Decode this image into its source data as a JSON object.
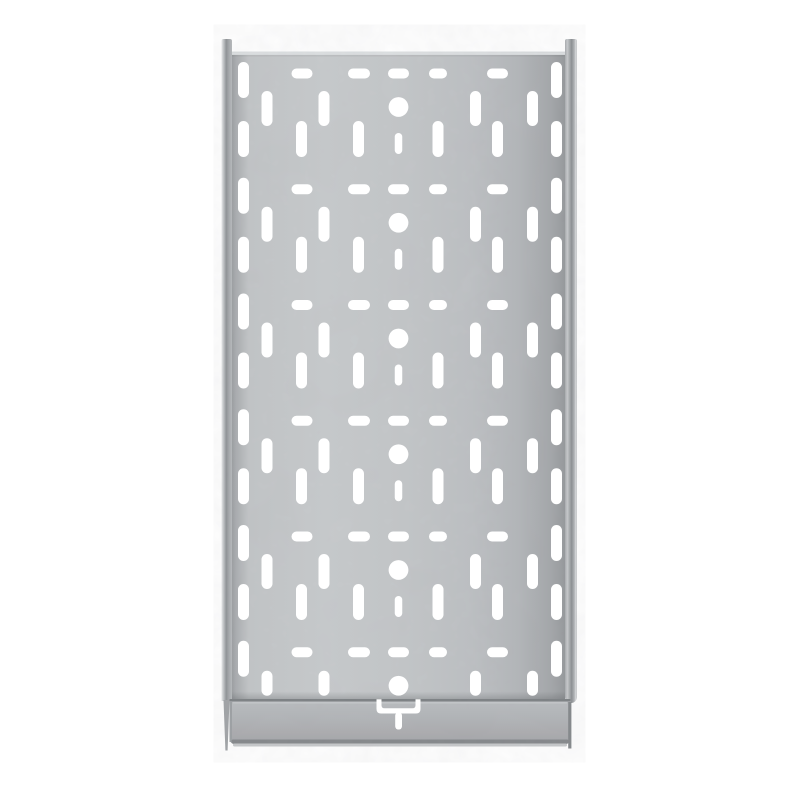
{
  "object": {
    "type": "galvanized-perforated-cable-tray",
    "view": "top-down product photo on white background"
  },
  "canvas": {
    "w": 800,
    "h": 800,
    "bg": "#ffffff"
  },
  "colors": {
    "hole": "#ffffff",
    "seam_dark": "#7c8083",
    "seam_light": "#c3c6c9",
    "bevel_highlight": "#edeff0",
    "bevel_face": "#dde0e2",
    "bevel_shadow": "rgba(0,0,0,0.05)",
    "plate_bottom_edge": "#84878a",
    "plate_bottom_light": "#c6c8ca",
    "plate_left_edge": "#9ca0a3",
    "plate_right_edge": "#83878a",
    "rail_tip": "#a0a3a6"
  },
  "gradients": {
    "railLeft": {
      "dir": "h",
      "stops": [
        [
          0,
          "#eaebec"
        ],
        [
          0.15,
          "#cbced0"
        ],
        [
          0.45,
          "#8f9396"
        ],
        [
          0.75,
          "#a8abae"
        ],
        [
          1,
          "#b6b9bc"
        ]
      ]
    },
    "railRight": {
      "dir": "h",
      "stops": [
        [
          0,
          "#a7aaad"
        ],
        [
          0.2,
          "#c7cacc"
        ],
        [
          0.55,
          "#8a8e91"
        ],
        [
          0.78,
          "#b2b5b8"
        ],
        [
          0.9,
          "#d9dbdd"
        ],
        [
          1,
          "#c2c4c6"
        ]
      ]
    },
    "panel": {
      "dir": "h",
      "stops": [
        [
          0,
          "#9b9ea1"
        ],
        [
          0.012,
          "#a9acaf"
        ],
        [
          0.05,
          "#c2c5c7"
        ],
        [
          0.28,
          "#c7cacc"
        ],
        [
          0.52,
          "#c3c6c8"
        ],
        [
          0.72,
          "#bdc0c3"
        ],
        [
          0.86,
          "#b3b6b9"
        ],
        [
          0.96,
          "#a3a6a9"
        ],
        [
          1,
          "#95989b"
        ]
      ]
    },
    "plate": {
      "dir": "v",
      "stops": [
        [
          0,
          "#b9bcbf"
        ],
        [
          0.4,
          "#b1b4b7"
        ],
        [
          0.75,
          "#ababae"
        ],
        [
          0.93,
          "#a4a7aa"
        ],
        [
          1,
          "#9da0a3"
        ]
      ]
    },
    "seamShadow": {
      "dir": "v",
      "stops": [
        [
          0,
          "rgba(70,74,77,0)"
        ],
        [
          1,
          "rgba(70,74,77,0.25)"
        ]
      ]
    }
  },
  "tray": {
    "leftRail": {
      "x": 221.5,
      "topY": 39,
      "w": 10.5,
      "botY": 701,
      "tip": "223.5,700 229.5,700 227.6,750.5 225.4,750.5"
    },
    "rightRail": {
      "x": 565,
      "topY": 39,
      "w": 12,
      "botY": 703,
      "edgeLine": {
        "x": 568.2,
        "w": 3.2,
        "y1": 702,
        "y2": 748.5
      }
    },
    "panel": {
      "x": 232,
      "y": 51,
      "w": 333,
      "h": 649
    },
    "bevel": {
      "hi_h": 1.3,
      "face_h": 2.6,
      "shadow_h": 1.6
    },
    "seamShadowRect": {
      "x": 232,
      "y": 691.5,
      "w": 333,
      "h": 7.5
    },
    "seam": {
      "x": 229.5,
      "y": 699,
      "w": 341,
      "h": 2.6
    },
    "seamLight": {
      "x": 233,
      "y": 701.8,
      "w": 334,
      "h": 1.8
    },
    "plate": {
      "x": 229.5,
      "y": 701.5,
      "w": 341,
      "h": 43,
      "r": 7,
      "bottomEdge": {
        "x": 231.5,
        "y": 739.5,
        "w": 337,
        "h": 4
      },
      "bottomLight": {
        "x": 233,
        "y": 743.5,
        "w": 334,
        "h": 3
      },
      "leftEdge": {
        "x": 229.5,
        "y": 702,
        "w": 2.5,
        "h": 40
      }
    }
  },
  "pattern": {
    "centerX": 398.5,
    "circleR": 9.9,
    "rowStartY": 107,
    "rowStep": 115.75,
    "rowCount": 6,
    "hRow": {
      "dy": -33.5,
      "h": 10,
      "cols": [
        302,
        359,
        398.5,
        438,
        497.5
      ],
      "w": [
        21,
        22,
        21,
        18,
        21
      ]
    },
    "upper": {
      "cols": [
        267,
        324,
        475.5,
        532.5
      ],
      "w": 11,
      "dy1": -16,
      "dy2": 19,
      "lastDy1": -15,
      "lastDy2": 10
    },
    "lower": {
      "cols": [
        301.5,
        358.5,
        438,
        497.5
      ],
      "w": 11,
      "dy1": 14,
      "dy2": 50
    },
    "centerSlot": {
      "w": 7.5,
      "dy1": 26,
      "dy2": 47
    },
    "edge": {
      "cols": [
        243.5,
        556.5
      ],
      "w": 11,
      "a": [
        -45,
        -9
      ],
      "b": [
        14,
        50
      ]
    }
  },
  "tSlot": {
    "outer": {
      "x1": 376.5,
      "x2": 420.5,
      "y1": 699.3,
      "y2": 713.5,
      "r": 4.5
    },
    "inner": {
      "x1": 381.5,
      "x2": 415.5,
      "y1": 699.3,
      "y2": 708.3,
      "r": 3
    },
    "stem": {
      "x": 395.2,
      "y": 712.5,
      "w": 6.8,
      "h": 17,
      "rx": 3.2
    }
  },
  "texture": {
    "fine": {
      "baseFrequency": 0.09,
      "gray": 0.42,
      "alpha": 0.07
    },
    "coarse": {
      "baseFrequency": 0.016,
      "gray": 0.34,
      "alpha": 0.06
    }
  }
}
